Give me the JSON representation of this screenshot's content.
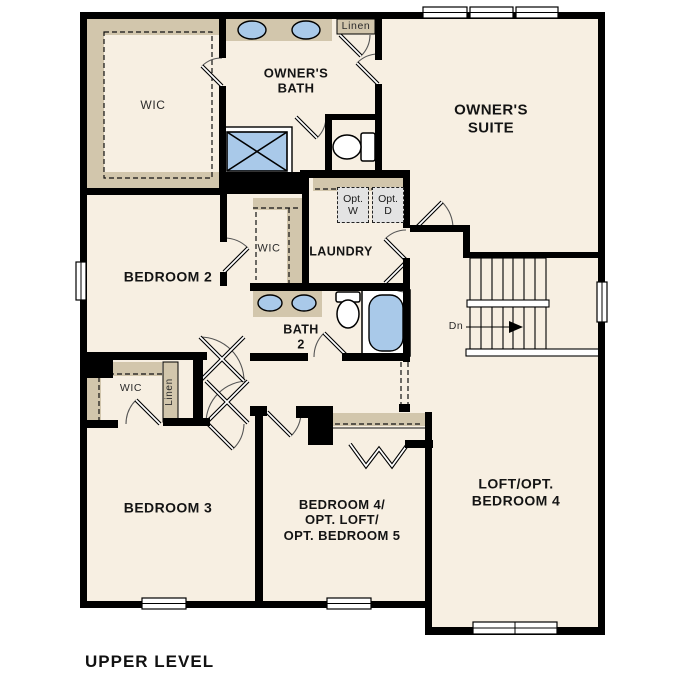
{
  "title": "UPPER LEVEL",
  "colors": {
    "floor": "#f7efe2",
    "wall": "#000000",
    "cabinetry_tan": "#d2c6ac",
    "fixture_blue": "#a9c9e9",
    "appliance_gray": "#e3e3e3"
  },
  "rooms": {
    "owners_wic": {
      "label": "WIC"
    },
    "owners_bath": {
      "line1": "OWNER'S",
      "line2": "BATH"
    },
    "linen_upper": {
      "label": "Linen"
    },
    "owners_suite": {
      "line1": "OWNER'S",
      "line2": "SUITE"
    },
    "bedroom_2": {
      "label": "BEDROOM 2"
    },
    "hall_wic": {
      "label": "WIC"
    },
    "laundry": {
      "label": "LAUNDRY",
      "opt_washer": {
        "line1": "Opt.",
        "line2": "W"
      },
      "opt_dryer": {
        "line1": "Opt.",
        "line2": "D"
      }
    },
    "bath_2": {
      "line1": "BATH",
      "line2": "2"
    },
    "stairs": {
      "down_label": "Dn"
    },
    "bedroom3_wic": {
      "label": "WIC"
    },
    "linen_lower": {
      "label": "Linen"
    },
    "bedroom_3": {
      "label": "BEDROOM 3"
    },
    "bedroom_4": {
      "line1": "BEDROOM 4/",
      "line2": "OPT. LOFT/",
      "line3": "OPT. BEDROOM 5"
    },
    "loft": {
      "line1": "LOFT/OPT.",
      "line2": "BEDROOM 4"
    }
  }
}
